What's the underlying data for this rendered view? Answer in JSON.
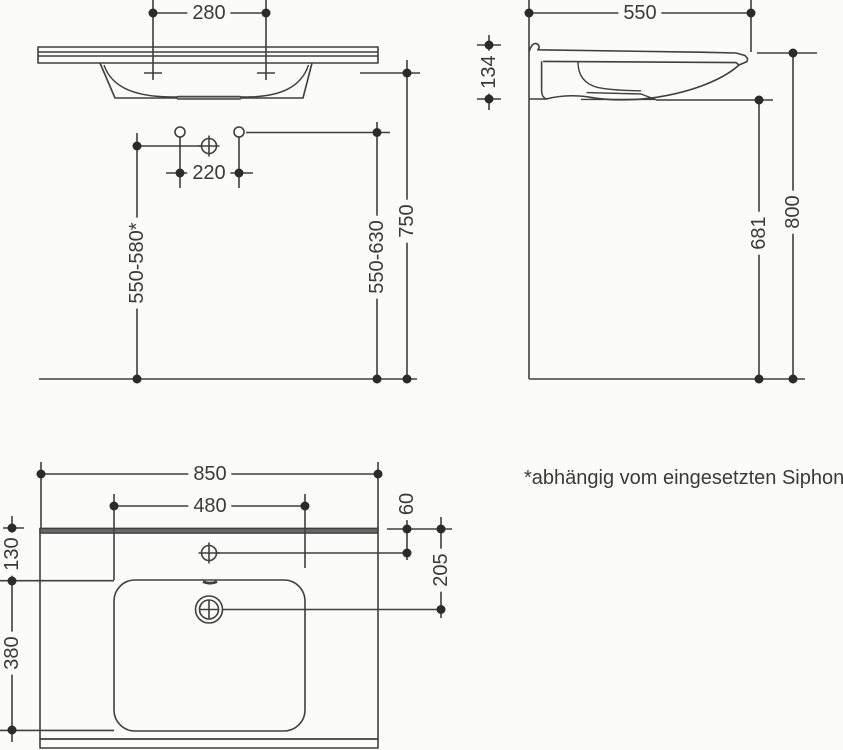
{
  "document": {
    "type": "technical-dimension-drawing",
    "subject": "wall-mounted washbasin",
    "units": "mm"
  },
  "footnote": {
    "text": "*abhängig vom eingesetzten Siphon"
  },
  "views": {
    "front": {
      "title": "front-elevation",
      "dims": {
        "tap_spacing": "280",
        "hole_spacing": "220",
        "height_range_left": "550-580*",
        "height_range_right": "550-630",
        "rim_height": "750"
      }
    },
    "side": {
      "title": "side-section",
      "dims": {
        "depth": "550",
        "apron_height": "134",
        "underside_clearance": "681",
        "top_height": "800"
      }
    },
    "plan": {
      "title": "plan-view",
      "dims": {
        "overall_width": "850",
        "tap_shelf_width": "480",
        "back_edge_offset": "60",
        "drain_offset": "205",
        "side_inset": "130",
        "basin_length": "380"
      }
    }
  },
  "icons": {
    "fixing_point": "circle-cross",
    "drain": "double-circle-cross",
    "tap_hole": "small-circle",
    "hole_center": "plus-cross"
  },
  "colors": {
    "line": "#3f3f3f",
    "text": "#3a3a3a",
    "dot": "#2b2b2b",
    "back_edge_band": "#686868",
    "background": "#fbfbfa"
  }
}
